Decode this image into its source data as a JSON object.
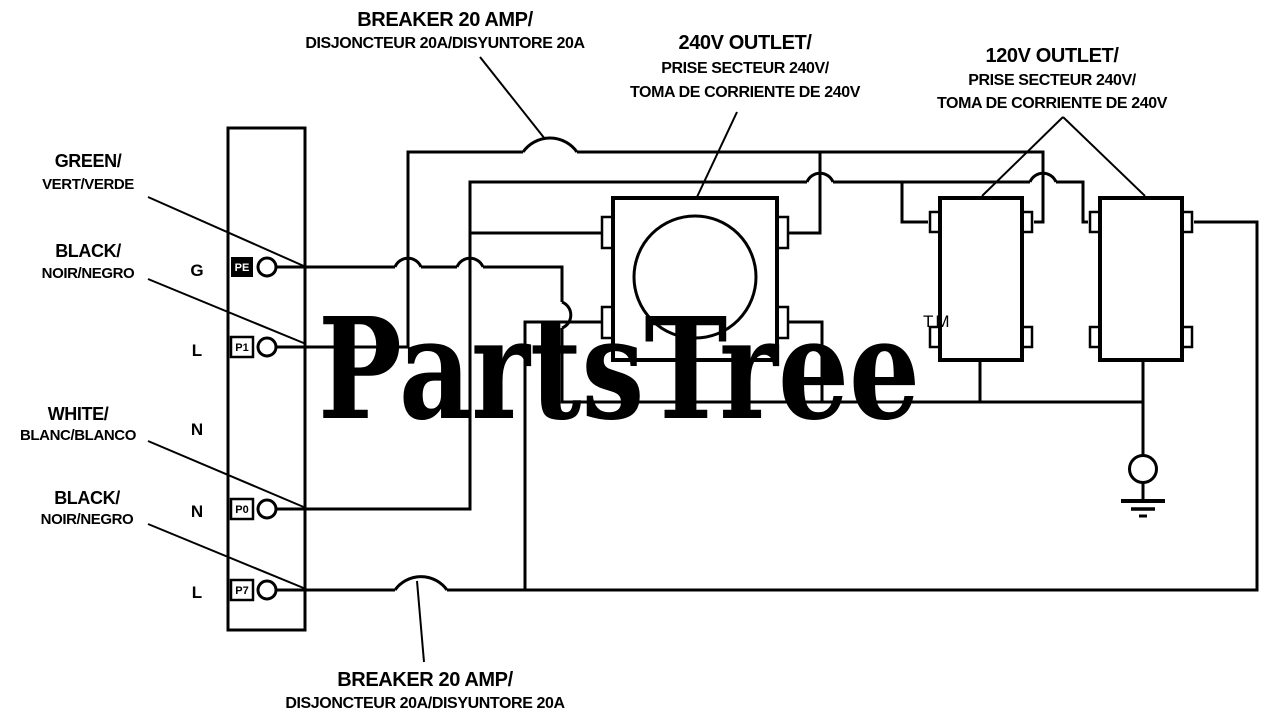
{
  "watermark": {
    "text": "PartsTree",
    "tm": "TM",
    "color": "#c9c9c9"
  },
  "colors": {
    "line": "#000000",
    "background": "#ffffff"
  },
  "labels": {
    "breaker_top": {
      "line1": "BREAKER 20 AMP/",
      "line2": "DISJONCTEUR 20A/DISYUNTORE 20A"
    },
    "breaker_bottom": {
      "line1": "BREAKER 20 AMP/",
      "line2": "DISJONCTEUR 20A/DISYUNTORE 20A"
    },
    "outlet_240v": {
      "line1": "240V OUTLET/",
      "line2": "PRISE SECTEUR 240V/",
      "line3": "TOMA DE CORRIENTE DE 240V"
    },
    "outlet_120v": {
      "line1": "120V OUTLET/",
      "line2": "PRISE SECTEUR 240V/",
      "line3": "TOMA DE CORRIENTE DE 240V"
    },
    "wire_green": {
      "line1": "GREEN/",
      "line2": "VERT/VERDE"
    },
    "wire_black_1": {
      "line1": "BLACK/",
      "line2": "NOIR/NEGRO"
    },
    "wire_white": {
      "line1": "WHITE/",
      "line2": "BLANC/BLANCO"
    },
    "wire_black_2": {
      "line1": "BLACK/",
      "line2": "NOIR/NEGRO"
    }
  },
  "terminals": {
    "g": {
      "letter": "G",
      "tag": "PE"
    },
    "l1": {
      "letter": "L",
      "tag": "P1"
    },
    "n1": {
      "letter": "N"
    },
    "n2": {
      "letter": "N",
      "tag": "P0"
    },
    "l2": {
      "letter": "L",
      "tag": "P7"
    }
  }
}
